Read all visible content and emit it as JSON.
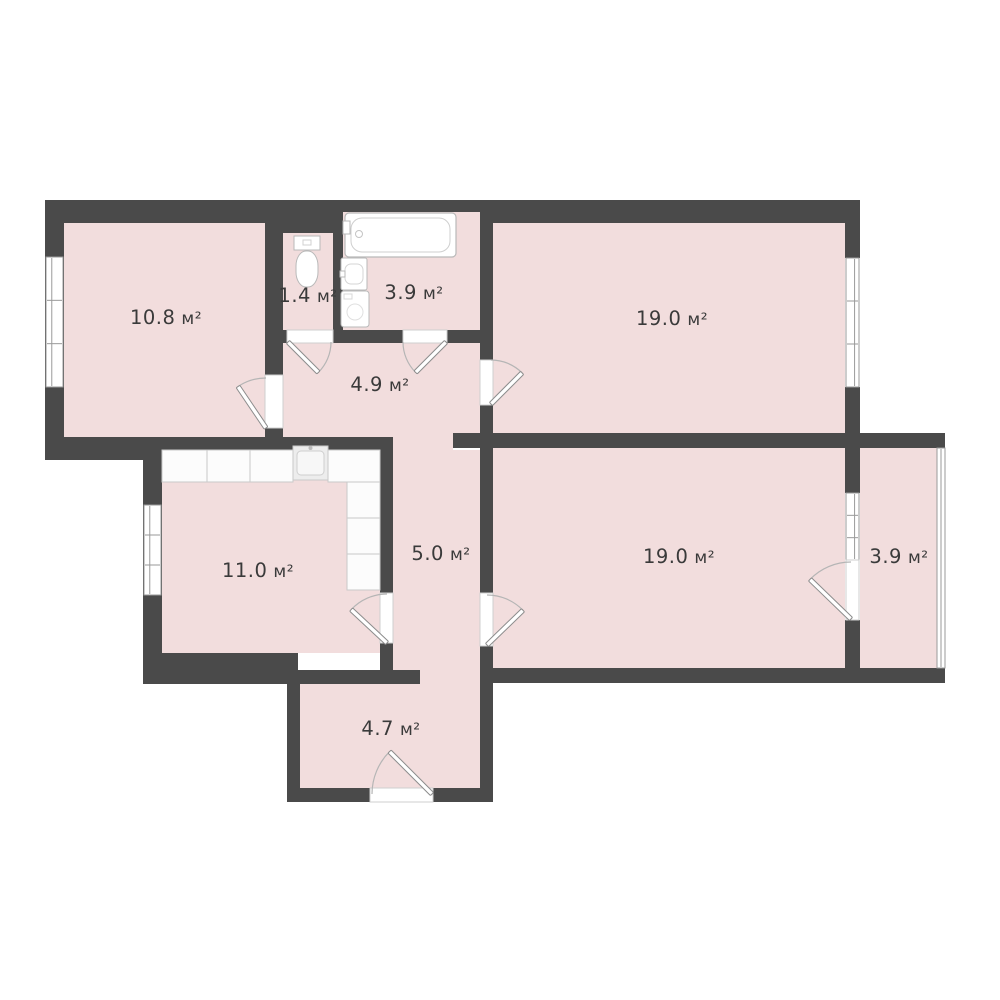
{
  "plan": {
    "type": "apartment-floor-plan",
    "canvas": {
      "width": 1000,
      "height": 1000
    },
    "colors": {
      "background": "#ffffff",
      "wall": "#4a4a4a",
      "floor": "#f2dddd",
      "fixture_fill": "#ffffff",
      "fixture_stroke": "#b9b9b9",
      "counter_fill": "#fcfcfc",
      "counter_stroke": "#c9c9c9",
      "sink_fill": "#ededed",
      "frame_stroke": "#9a9a9a",
      "opening_stroke": "#cfcfcf",
      "arc_stroke": "#b5b5b5",
      "leaf_stroke": "#8c8c8c",
      "label": "#3a3a3a"
    },
    "area_unit": "м²",
    "rooms": [
      {
        "name": "room-top-left",
        "area": "10.8",
        "unit": "м²",
        "label": {
          "x": 166,
          "y": 317
        },
        "rects": [
          [
            64,
            223,
            201,
            214
          ]
        ]
      },
      {
        "name": "wc",
        "area": "1.4",
        "unit": "м²",
        "label": {
          "x": 308,
          "y": 295
        },
        "rects": [
          [
            283,
            233,
            50,
            97
          ]
        ]
      },
      {
        "name": "bathroom",
        "area": "3.9",
        "unit": "м²",
        "label": {
          "x": 414,
          "y": 292
        },
        "rects": [
          [
            343,
            212,
            137,
            118
          ]
        ]
      },
      {
        "name": "hallway",
        "area": "4.9",
        "unit": "м²",
        "label": {
          "x": 380,
          "y": 384
        },
        "rects": [
          [
            283,
            343,
            197,
            94
          ],
          [
            393,
            433,
            60,
            17
          ]
        ]
      },
      {
        "name": "room-top-right",
        "area": "19.0",
        "unit": "м²",
        "label": {
          "x": 672,
          "y": 318
        },
        "rects": [
          [
            493,
            223,
            352,
            210
          ]
        ]
      },
      {
        "name": "kitchen",
        "area": "11.0",
        "unit": "м²",
        "label": {
          "x": 258,
          "y": 570
        },
        "rects": [
          [
            162,
            450,
            218,
            203
          ]
        ]
      },
      {
        "name": "corridor",
        "area": "5.0",
        "unit": "м²",
        "label": {
          "x": 441,
          "y": 553
        },
        "rects": [
          [
            393,
            450,
            87,
            232
          ],
          [
            420,
            670,
            60,
            14
          ]
        ]
      },
      {
        "name": "room-bottom-right",
        "area": "19.0",
        "unit": "м²",
        "label": {
          "x": 679,
          "y": 556
        },
        "rects": [
          [
            493,
            448,
            352,
            220
          ]
        ]
      },
      {
        "name": "balcony",
        "area": "3.9",
        "unit": "м²",
        "label": {
          "x": 899,
          "y": 556
        },
        "rects": [
          [
            860,
            448,
            77,
            220
          ]
        ]
      },
      {
        "name": "entrance-hall",
        "area": "4.7",
        "unit": "м²",
        "label": {
          "x": 391,
          "y": 728
        },
        "rects": [
          [
            300,
            682,
            180,
            106
          ]
        ]
      }
    ],
    "walls": [
      [
        45,
        200,
        298,
        23
      ],
      [
        343,
        200,
        137,
        12
      ],
      [
        480,
        200,
        380,
        23
      ],
      [
        265,
        223,
        78,
        10
      ],
      [
        45,
        223,
        19,
        237
      ],
      [
        45,
        437,
        117,
        23
      ],
      [
        162,
        437,
        231,
        13
      ],
      [
        265,
        223,
        18,
        152
      ],
      [
        265,
        427,
        18,
        23
      ],
      [
        333,
        233,
        10,
        97
      ],
      [
        265,
        330,
        22,
        13
      ],
      [
        333,
        330,
        70,
        13
      ],
      [
        447,
        330,
        33,
        13
      ],
      [
        480,
        223,
        13,
        137
      ],
      [
        480,
        405,
        13,
        43
      ],
      [
        453,
        433,
        27,
        15
      ],
      [
        493,
        433,
        367,
        15
      ],
      [
        860,
        433,
        85,
        15
      ],
      [
        845,
        200,
        15,
        58
      ],
      [
        845,
        387,
        15,
        61
      ],
      [
        845,
        448,
        15,
        45
      ],
      [
        845,
        620,
        15,
        63
      ],
      [
        480,
        448,
        13,
        145
      ],
      [
        480,
        646,
        13,
        37
      ],
      [
        143,
        450,
        19,
        234
      ],
      [
        380,
        450,
        13,
        143
      ],
      [
        380,
        643,
        13,
        41
      ],
      [
        143,
        653,
        155,
        31
      ],
      [
        290,
        670,
        130,
        14
      ],
      [
        287,
        684,
        13,
        118
      ],
      [
        480,
        670,
        13,
        132
      ],
      [
        287,
        788,
        83,
        14
      ],
      [
        433,
        788,
        60,
        14
      ],
      [
        480,
        668,
        380,
        15
      ],
      [
        860,
        668,
        85,
        15
      ]
    ],
    "windows": [
      {
        "x": 46,
        "y": 257,
        "w": 17,
        "h": 130,
        "outer": "left"
      },
      {
        "x": 144,
        "y": 505,
        "w": 17,
        "h": 90,
        "outer": "left"
      },
      {
        "x": 846,
        "y": 258,
        "w": 13,
        "h": 129,
        "outer": "right"
      },
      {
        "x": 846,
        "y": 493,
        "w": 13,
        "h": 67,
        "outer": "right"
      }
    ],
    "glazing": [
      {
        "x": 937,
        "y": 448,
        "w": 8,
        "h": 220
      }
    ],
    "doors": [
      {
        "name": "door-room-top-left",
        "opening": [
          265,
          375,
          18,
          53
        ],
        "hinge": [
          266,
          428
        ],
        "r": 50,
        "a0": 90,
        "a1": 124
      },
      {
        "name": "door-wc",
        "opening": [
          287,
          330,
          46,
          13
        ],
        "hinge": [
          288,
          342
        ],
        "r": 43,
        "a0": 0,
        "a1": -45
      },
      {
        "name": "door-bathroom",
        "opening": [
          403,
          330,
          44,
          13
        ],
        "hinge": [
          446,
          342
        ],
        "r": 43,
        "a0": 180,
        "a1": 225
      },
      {
        "name": "door-room-top-right",
        "opening": [
          480,
          360,
          13,
          45
        ],
        "hinge": [
          491,
          404
        ],
        "r": 44,
        "a0": 90,
        "a1": 45
      },
      {
        "name": "door-kitchen",
        "opening": [
          380,
          593,
          13,
          50
        ],
        "hinge": [
          387,
          643
        ],
        "r": 49,
        "a0": 90,
        "a1": 137
      },
      {
        "name": "door-room-bottom-right",
        "opening": [
          480,
          593,
          13,
          53
        ],
        "hinge": [
          487,
          645
        ],
        "r": 50,
        "a0": 90,
        "a1": 44
      },
      {
        "name": "door-balcony",
        "opening": [
          846,
          560,
          13,
          60
        ],
        "hinge": [
          851,
          619
        ],
        "r": 57,
        "a0": 90,
        "a1": 136
      },
      {
        "name": "door-entrance",
        "opening": [
          370,
          788,
          63,
          14
        ],
        "hinge": [
          432,
          794
        ],
        "r": 60,
        "a0": 180,
        "a1": 135
      }
    ],
    "fixtures": [
      {
        "type": "bathtub",
        "rect": [
          345,
          213,
          111,
          44
        ]
      },
      {
        "type": "toilet",
        "rect": [
          294,
          236,
          26,
          51
        ]
      },
      {
        "type": "sink",
        "rect": [
          341,
          258,
          26,
          32
        ]
      },
      {
        "type": "washing-machine",
        "rect": [
          341,
          291,
          28,
          36
        ]
      },
      {
        "type": "counter",
        "rect": [
          162,
          450,
          45,
          32
        ]
      },
      {
        "type": "counter",
        "rect": [
          207,
          450,
          43,
          32
        ]
      },
      {
        "type": "counter",
        "rect": [
          250,
          450,
          43,
          32
        ]
      },
      {
        "type": "counter-sink",
        "rect": [
          293,
          446,
          35,
          34
        ]
      },
      {
        "type": "counter",
        "rect": [
          328,
          450,
          52,
          32
        ]
      },
      {
        "type": "counter",
        "rect": [
          347,
          482,
          33,
          36
        ]
      },
      {
        "type": "counter",
        "rect": [
          347,
          518,
          33,
          36
        ]
      },
      {
        "type": "counter",
        "rect": [
          347,
          554,
          33,
          36
        ]
      }
    ]
  }
}
